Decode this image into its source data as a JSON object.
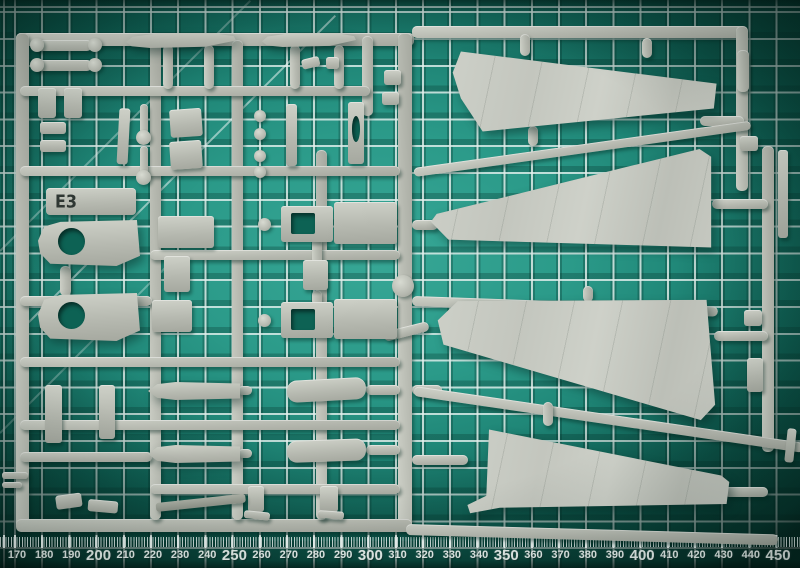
{
  "colors": {
    "mat_teal_center": "#2e9c8b",
    "mat_teal_edge": "#0a4e42",
    "grid_line_white": "#e4f0ed",
    "plastic_grey": "#b9bcb3",
    "plastic_highlight": "#ced1c8",
    "plastic_shadow": "#8e9289",
    "stencil_text": "#2f3733"
  },
  "sprue": {
    "label": "E3",
    "parts": [
      {
        "t": "bar",
        "x": 16,
        "y": 33,
        "w": 398,
        "h": 13
      },
      {
        "t": "bar",
        "x": 16,
        "y": 33,
        "w": 13,
        "h": 497
      },
      {
        "t": "bar",
        "x": 398,
        "y": 33,
        "w": 14,
        "h": 497
      },
      {
        "t": "bar",
        "x": 16,
        "y": 519,
        "w": 396,
        "h": 13
      },
      {
        "t": "bar",
        "x": 150,
        "y": 40,
        "w": 11,
        "h": 480
      },
      {
        "t": "bar",
        "x": 232,
        "y": 40,
        "w": 11,
        "h": 480
      },
      {
        "t": "bar",
        "x": 316,
        "y": 150,
        "w": 11,
        "h": 370
      },
      {
        "t": "bar",
        "x": 362,
        "y": 36,
        "w": 11,
        "h": 80
      },
      {
        "t": "bar",
        "x": 20,
        "y": 86,
        "w": 350,
        "h": 10
      },
      {
        "t": "bar",
        "x": 20,
        "y": 166,
        "w": 380,
        "h": 10
      },
      {
        "t": "bar",
        "x": 150,
        "y": 250,
        "w": 250,
        "h": 10
      },
      {
        "t": "bar",
        "x": 20,
        "y": 296,
        "w": 132,
        "h": 10
      },
      {
        "t": "bar",
        "x": 20,
        "y": 357,
        "w": 380,
        "h": 10
      },
      {
        "t": "bar",
        "x": 20,
        "y": 420,
        "w": 380,
        "h": 10
      },
      {
        "t": "bar",
        "x": 150,
        "y": 484,
        "w": 250,
        "h": 10
      },
      {
        "t": "bar",
        "x": 20,
        "y": 452,
        "w": 132,
        "h": 10
      },
      {
        "t": "bar",
        "x": 412,
        "y": 26,
        "w": 334,
        "h": 12
      },
      {
        "t": "bar",
        "x": 736,
        "y": 26,
        "w": 12,
        "h": 165
      },
      {
        "t": "bar",
        "x": 700,
        "y": 116,
        "w": 44,
        "h": 10
      },
      {
        "t": "bar",
        "x": 762,
        "y": 146,
        "w": 12,
        "h": 306
      },
      {
        "t": "bar",
        "x": 712,
        "y": 199,
        "w": 56,
        "h": 10
      },
      {
        "t": "bar",
        "x": 714,
        "y": 331,
        "w": 54,
        "h": 10
      },
      {
        "t": "bar",
        "x": 724,
        "y": 487,
        "w": 44,
        "h": 10
      },
      {
        "t": "bar",
        "x": 412,
        "y": 220,
        "w": 26,
        "h": 10
      },
      {
        "t": "bar",
        "x": 412,
        "y": 385,
        "w": 30,
        "h": 10
      },
      {
        "t": "bar",
        "x": 412,
        "y": 455,
        "w": 56,
        "h": 10
      },
      {
        "t": "bar",
        "x": 414,
        "y": 386,
        "w": 394,
        "h": 10,
        "rot": 8.3
      },
      {
        "t": "bar",
        "x": 406,
        "y": 524,
        "w": 372,
        "h": 11,
        "rot": 1.6
      },
      {
        "t": "bar",
        "x": 414,
        "y": 168,
        "w": 340,
        "h": 9,
        "rot": -8
      },
      {
        "t": "bar",
        "x": 412,
        "y": 296,
        "w": 306,
        "h": 10,
        "rot": 2
      },
      {
        "t": "bar",
        "x": 384,
        "y": 332,
        "w": 46,
        "h": 10,
        "rot": -14
      },
      {
        "t": "bar",
        "x": 163,
        "y": 45,
        "w": 10,
        "h": 44
      },
      {
        "t": "bar",
        "x": 204,
        "y": 45,
        "w": 10,
        "h": 44
      },
      {
        "t": "bar",
        "x": 290,
        "y": 45,
        "w": 10,
        "h": 44
      },
      {
        "t": "bar",
        "x": 334,
        "y": 45,
        "w": 10,
        "h": 44
      },
      {
        "t": "bar",
        "x": 520,
        "y": 34,
        "w": 10,
        "h": 22
      },
      {
        "t": "bar",
        "x": 642,
        "y": 38,
        "w": 10,
        "h": 20
      },
      {
        "t": "bar",
        "x": 528,
        "y": 126,
        "w": 10,
        "h": 20
      },
      {
        "t": "bar",
        "x": 583,
        "y": 286,
        "w": 10,
        "h": 16
      },
      {
        "t": "bar",
        "x": 543,
        "y": 402,
        "w": 10,
        "h": 24
      },
      {
        "t": "bar",
        "x": 60,
        "y": 266,
        "w": 11,
        "h": 30
      },
      {
        "t": "bar",
        "x": 312,
        "y": 238,
        "w": 10,
        "h": 26
      },
      {
        "t": "bar",
        "x": 312,
        "y": 290,
        "w": 10,
        "h": 16
      },
      {
        "t": "bar",
        "x": 366,
        "y": 385,
        "w": 34,
        "h": 10
      },
      {
        "t": "bar",
        "x": 366,
        "y": 445,
        "w": 34,
        "h": 10
      },
      {
        "t": "bar",
        "x": 238,
        "y": 386,
        "w": 14,
        "h": 9
      },
      {
        "t": "bar",
        "x": 238,
        "y": 449,
        "w": 14,
        "h": 9
      },
      {
        "t": "bar",
        "x": 737,
        "y": 50,
        "w": 12,
        "h": 42
      },
      {
        "t": "wing",
        "n": "wing-part-upper",
        "x": 450,
        "y": 45,
        "w": 272,
        "h": 92,
        "poly": "polygon(1% 30%, 4% 7%, 98% 42%, 97% 69%, 12% 94%, 4% 58%)"
      },
      {
        "t": "wing",
        "n": "wing-part-second",
        "x": 425,
        "y": 140,
        "w": 292,
        "h": 112,
        "poly": "polygon(2% 73%, 4% 66%, 94% 8%, 98% 15%, 98% 96%, 8% 89%)"
      },
      {
        "t": "wing",
        "n": "wing-part-third",
        "x": 432,
        "y": 296,
        "w": 286,
        "h": 128,
        "poly": "polygon(2% 19%, 9% 4%, 96% 3%, 99% 85%, 94% 97%, 4% 38%)"
      },
      {
        "t": "wing",
        "n": "wing-part-lower",
        "x": 462,
        "y": 424,
        "w": 270,
        "h": 92,
        "poly": "polygon(10% 6%, 96% 56%, 99% 63%, 98% 87%, 14% 91%, 3% 97%, 2% 88%, 9% 78%)"
      },
      {
        "t": "part",
        "n": "stabilizer-blade",
        "x": 126,
        "y": 33,
        "w": 110,
        "h": 15,
        "poly": "polygon(0% 60%, 6% 25%, 28% 4%, 78% 0%, 98% 22%, 100% 50%, 72% 92%, 22% 100%, 5% 88%)"
      },
      {
        "t": "part",
        "n": "stabilizer-blade",
        "x": 262,
        "y": 33,
        "w": 94,
        "h": 14,
        "poly": "polygon(0% 60%, 6% 25%, 28% 4%, 78% 0%, 98% 22%, 100% 50%, 72% 92%, 22% 100%, 5% 88%)"
      },
      {
        "t": "part",
        "x": 34,
        "y": 40,
        "w": 58,
        "h": 11,
        "r": 5
      },
      {
        "t": "disc",
        "x": 30,
        "y": 38,
        "w": 14,
        "h": 14
      },
      {
        "t": "disc",
        "x": 88,
        "y": 38,
        "w": 14,
        "h": 14
      },
      {
        "t": "part",
        "x": 34,
        "y": 60,
        "w": 58,
        "h": 11,
        "r": 5
      },
      {
        "t": "disc",
        "x": 30,
        "y": 58,
        "w": 14,
        "h": 14
      },
      {
        "t": "disc",
        "x": 88,
        "y": 58,
        "w": 14,
        "h": 14
      },
      {
        "t": "part",
        "x": 38,
        "y": 88,
        "w": 18,
        "h": 30
      },
      {
        "t": "part",
        "x": 64,
        "y": 88,
        "w": 18,
        "h": 30
      },
      {
        "t": "part",
        "x": 40,
        "y": 122,
        "w": 26,
        "h": 12
      },
      {
        "t": "part",
        "x": 40,
        "y": 140,
        "w": 26,
        "h": 12
      },
      {
        "t": "part",
        "x": 118,
        "y": 108,
        "w": 11,
        "h": 56,
        "rot": 3
      },
      {
        "t": "bar",
        "x": 140,
        "y": 104,
        "w": 8,
        "h": 30
      },
      {
        "t": "disc",
        "x": 136,
        "y": 130,
        "w": 15,
        "h": 15
      },
      {
        "t": "bar",
        "x": 140,
        "y": 146,
        "w": 8,
        "h": 28
      },
      {
        "t": "disc",
        "x": 136,
        "y": 170,
        "w": 15,
        "h": 15
      },
      {
        "t": "part",
        "x": 170,
        "y": 110,
        "w": 32,
        "h": 28,
        "rot": -4
      },
      {
        "t": "part",
        "x": 170,
        "y": 142,
        "w": 32,
        "h": 28,
        "rot": -4
      },
      {
        "t": "disc",
        "x": 254,
        "y": 110,
        "w": 12,
        "h": 12
      },
      {
        "t": "disc",
        "x": 254,
        "y": 128,
        "w": 12,
        "h": 12
      },
      {
        "t": "disc",
        "x": 254,
        "y": 150,
        "w": 12,
        "h": 12
      },
      {
        "t": "disc",
        "x": 254,
        "y": 166,
        "w": 12,
        "h": 12
      },
      {
        "t": "part",
        "x": 286,
        "y": 104,
        "w": 11,
        "h": 62
      },
      {
        "t": "part",
        "x": 348,
        "y": 102,
        "w": 16,
        "h": 62
      },
      {
        "t": "hole",
        "x": 352,
        "y": 116,
        "w": 8,
        "h": 26
      },
      {
        "t": "part",
        "x": 384,
        "y": 70,
        "w": 17,
        "h": 15
      },
      {
        "t": "part",
        "x": 382,
        "y": 92,
        "w": 17,
        "h": 13
      },
      {
        "t": "part",
        "x": 302,
        "y": 60,
        "w": 18,
        "h": 10,
        "rot": -14
      },
      {
        "t": "part",
        "x": 326,
        "y": 57,
        "w": 13,
        "h": 12
      },
      {
        "t": "part",
        "n": "gate-label-tab",
        "x": 46,
        "y": 188,
        "w": 90,
        "h": 27,
        "r": 4
      },
      {
        "t": "part",
        "n": "part-with-hole",
        "x": 38,
        "y": 220,
        "w": 102,
        "h": 46,
        "poly": "polygon(0% 45%, 6% 14%, 22% 4%, 97% 0%, 100% 78%, 77% 100%, 12% 95%, 2% 72%)"
      },
      {
        "t": "hole",
        "x": 58,
        "y": 228,
        "w": 27,
        "h": 27
      },
      {
        "t": "part",
        "n": "part-with-hole",
        "x": 38,
        "y": 293,
        "w": 102,
        "h": 48,
        "poly": "polygon(0% 45%, 6% 14%, 22% 4%, 97% 0%, 100% 78%, 77% 100%, 12% 95%, 2% 72%)"
      },
      {
        "t": "hole",
        "x": 58,
        "y": 302,
        "w": 27,
        "h": 27
      },
      {
        "t": "part",
        "x": 158,
        "y": 216,
        "w": 56,
        "h": 32
      },
      {
        "t": "part",
        "x": 164,
        "y": 256,
        "w": 26,
        "h": 36
      },
      {
        "t": "part",
        "x": 152,
        "y": 300,
        "w": 40,
        "h": 32
      },
      {
        "t": "part",
        "n": "cockpit-tub",
        "x": 281,
        "y": 206,
        "w": 52,
        "h": 36
      },
      {
        "t": "holeRect",
        "x": 291,
        "y": 213,
        "w": 24,
        "h": 21
      },
      {
        "t": "part",
        "x": 334,
        "y": 202,
        "w": 63,
        "h": 42
      },
      {
        "t": "part",
        "n": "cockpit-tub",
        "x": 281,
        "y": 302,
        "w": 52,
        "h": 36
      },
      {
        "t": "holeRect",
        "x": 291,
        "y": 309,
        "w": 24,
        "h": 21
      },
      {
        "t": "part",
        "x": 334,
        "y": 299,
        "w": 63,
        "h": 40
      },
      {
        "t": "part",
        "x": 303,
        "y": 260,
        "w": 25,
        "h": 30
      },
      {
        "t": "disc",
        "x": 258,
        "y": 218,
        "w": 13,
        "h": 13
      },
      {
        "t": "disc",
        "x": 258,
        "y": 314,
        "w": 13,
        "h": 13
      },
      {
        "t": "disc",
        "n": "runner-node",
        "x": 392,
        "y": 275,
        "w": 22,
        "h": 22
      },
      {
        "t": "part",
        "n": "gear-door",
        "x": 45,
        "y": 385,
        "w": 17,
        "h": 58
      },
      {
        "t": "part",
        "n": "gear-door",
        "x": 99,
        "y": 385,
        "w": 16,
        "h": 54
      },
      {
        "t": "part",
        "n": "drop-tank",
        "x": 148,
        "y": 382,
        "w": 92,
        "h": 18,
        "poly": "polygon(0% 50%, 10% 12%, 30% 0%, 100% 8%, 100% 92%, 30% 100%, 10% 88%)"
      },
      {
        "t": "part",
        "n": "drop-tank",
        "x": 148,
        "y": 445,
        "w": 92,
        "h": 18,
        "poly": "polygon(0% 50%, 10% 12%, 30% 0%, 100% 8%, 100% 92%, 30% 100%, 10% 88%)"
      },
      {
        "t": "part",
        "n": "cylinder-part",
        "x": 287,
        "y": 381,
        "w": 79,
        "h": 22,
        "r": 10,
        "rot": -3
      },
      {
        "t": "part",
        "n": "cylinder-part",
        "x": 287,
        "y": 441,
        "w": 79,
        "h": 22,
        "r": 10,
        "rot": -2
      },
      {
        "t": "part",
        "x": 248,
        "y": 486,
        "w": 16,
        "h": 26
      },
      {
        "t": "part",
        "x": 320,
        "y": 486,
        "w": 18,
        "h": 26
      },
      {
        "t": "part",
        "x": 244,
        "y": 510,
        "w": 26,
        "h": 8,
        "rot": 6
      },
      {
        "t": "part",
        "x": 318,
        "y": 510,
        "w": 26,
        "h": 8,
        "rot": 4
      },
      {
        "t": "dark",
        "n": "angled-blade",
        "x": 156,
        "y": 503,
        "w": 90,
        "h": 9,
        "rot": -6
      },
      {
        "t": "part",
        "x": 56,
        "y": 496,
        "w": 26,
        "h": 14,
        "rot": -8
      },
      {
        "t": "part",
        "x": 88,
        "y": 499,
        "w": 30,
        "h": 12,
        "rot": 5
      },
      {
        "t": "part",
        "x": 2,
        "y": 472,
        "w": 26,
        "h": 7
      },
      {
        "t": "part",
        "x": 2,
        "y": 482,
        "w": 20,
        "h": 6
      },
      {
        "t": "part",
        "x": 778,
        "y": 150,
        "w": 10,
        "h": 88
      },
      {
        "t": "part",
        "x": 740,
        "y": 136,
        "w": 18,
        "h": 15
      },
      {
        "t": "part",
        "x": 744,
        "y": 310,
        "w": 18,
        "h": 16
      },
      {
        "t": "part",
        "x": 747,
        "y": 358,
        "w": 16,
        "h": 34
      },
      {
        "t": "part",
        "x": 786,
        "y": 428,
        "w": 9,
        "h": 34,
        "rot": 6
      }
    ]
  },
  "ruler": {
    "numbers": [
      170,
      180,
      190,
      200,
      210,
      220,
      230,
      240,
      250,
      260,
      270,
      280,
      290,
      300,
      310,
      320,
      330,
      340,
      350,
      360,
      370,
      380,
      390,
      400,
      410,
      420,
      430,
      440,
      450
    ],
    "bold_multiple": 50,
    "start_x": 17,
    "step": 27.18
  }
}
